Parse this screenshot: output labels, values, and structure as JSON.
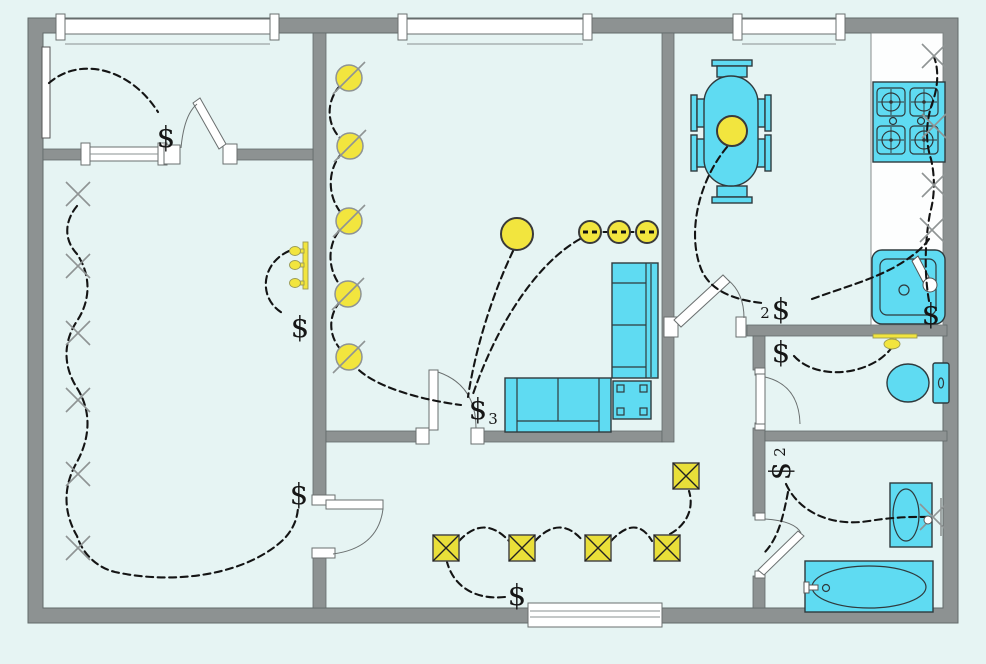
{
  "plan": {
    "colors": {
      "background": "#e6f4f3",
      "wall": "#8d9292",
      "fixture": "#5fdbf2",
      "lamp": "#f2e53e",
      "outlet": "#e9df39",
      "wire": "#141414"
    },
    "switch_symbol": "$",
    "switches": {
      "entry_room": {
        "label": "$"
      },
      "left_room_lamp": {
        "label": "$"
      },
      "left_room_lights": {
        "label": "$"
      },
      "living_room": {
        "label": "$",
        "sub": "3"
      },
      "dining_room": {
        "label": "$",
        "sub": "2"
      },
      "kitchen": {
        "label": "$"
      },
      "wc": {
        "label": "$"
      },
      "bathroom": {
        "label": "$",
        "sub": "2"
      },
      "hall": {
        "label": "$"
      }
    },
    "symbol_counts": {
      "switches": 9,
      "ceiling_lights_slashed": 5,
      "pendant_lights": 2,
      "downlights": 3,
      "wall_lights_x_left_room": 6,
      "wall_lights_x_kitchen": 4,
      "multi_bulb_sconces": 2,
      "outlets": 5,
      "windows": 4,
      "doors": 6
    }
  }
}
